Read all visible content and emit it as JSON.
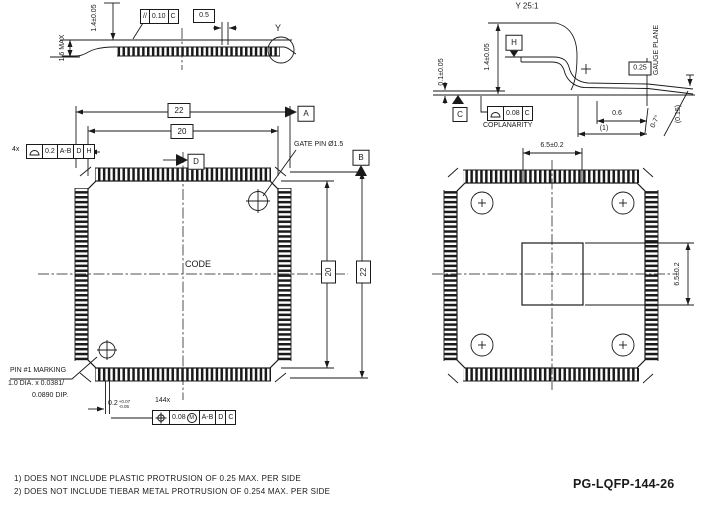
{
  "part_number": "PG-LQFP-144-26",
  "notes": [
    "1) DOES NOT INCLUDE PLASTIC PROTRUSION OF 0.25 MAX. PER SIDE",
    "2) DOES NOT INCLUDE TIEBAR METAL PROTRUSION OF 0.254 MAX. PER SIDE"
  ],
  "side_view": {
    "height_max": "1.6 MAX",
    "body_thickness": "1.4±0.05",
    "parallelism": {
      "symbol": "//",
      "tolerance": "0.10",
      "datum": "C"
    },
    "pitch": "0.5",
    "detail_label": "Y"
  },
  "detail_view": {
    "title": "Y 25:1",
    "datum_h": "H",
    "body_thickness": "1.4±0.05",
    "standoff": "0.1±0.05",
    "datum_c": "C",
    "coplanarity": {
      "tolerance": "0.08",
      "datum": "C",
      "label": "COPLANARITY"
    },
    "gauge_offset": "0.25",
    "gauge_plane_label": "GAUGE PLANE",
    "foot_length": "0.6",
    "foot_ref": "(1)",
    "foot_angle": "0-7°",
    "tip_ref": "(0.15)"
  },
  "top_view": {
    "overall_width": "22",
    "body_width": "20",
    "overall_height": "22",
    "body_height": "20",
    "profile_frame": {
      "count": "4x",
      "tolerance": "0.2",
      "datums": [
        "A-B",
        "D",
        "H"
      ]
    },
    "datum_a": "A",
    "datum_b": "B",
    "datum_d": "D",
    "gate_pin": "GATE PIN Ø1.5",
    "code": "CODE",
    "pin1_marking": [
      "PIN #1 MARKING",
      "1.0 DIA. x 0.0381/",
      "0.0890 DIP."
    ],
    "lead_width": {
      "value": "0.2",
      "plus": "+0.07",
      "minus": "-0.05"
    },
    "position_frame": {
      "count": "144x",
      "tolerance": "0.08",
      "modifier": "M",
      "datums": [
        "A-B",
        "D",
        "C"
      ]
    }
  },
  "bottom_view": {
    "pad_width": "6.5±0.2",
    "pad_height": "6.5±0.2"
  },
  "icons": {
    "profile_symbol": "profile-of-surface",
    "position_symbol": "true-position",
    "modifier_m": "max-material-condition"
  },
  "colors": {
    "line": "#1a1a1a",
    "background": "#ffffff"
  }
}
